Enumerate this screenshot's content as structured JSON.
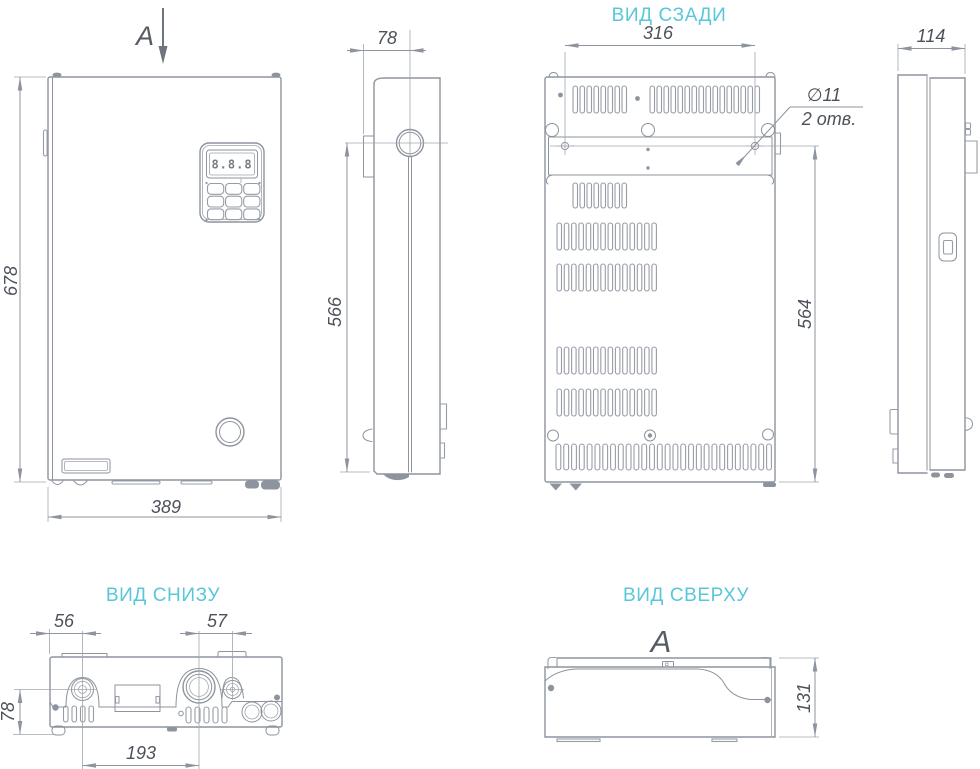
{
  "palette": {
    "accent": "#58c7da",
    "line": "#8d949e",
    "text": "#4d525a"
  },
  "front_view": {
    "section_arrow_label": "A",
    "display_value": "8.8.8",
    "dim_height": "678",
    "dim_width": "389"
  },
  "side_view_left": {
    "dim_pipe_offset": "78",
    "dim_pipe_to_bottom": "566"
  },
  "rear_view": {
    "title": "ВИД СЗАДИ",
    "dim_mount_holes_spacing": "316",
    "dim_bracket_to_bottom": "564",
    "callout_hole_diameter": "∅11",
    "callout_hole_count": "2 отв."
  },
  "side_view_right": {
    "dim_depth": "114"
  },
  "bottom_view": {
    "title": "ВИД СНИЗУ",
    "dim_left_pipe_offset": "56",
    "dim_valve_offset": "57",
    "dim_pipe_spacing": "193",
    "dim_pipe_depth": "78"
  },
  "top_view": {
    "title": "ВИД СВЕРХУ",
    "section_label": "A",
    "dim_depth": "131"
  }
}
